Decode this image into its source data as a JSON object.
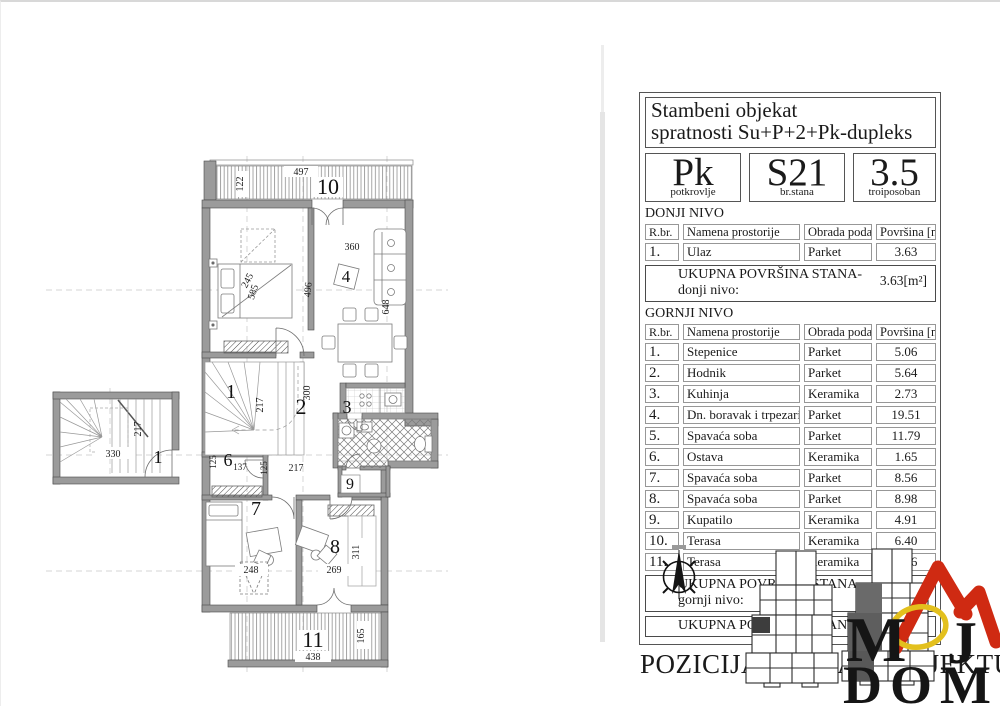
{
  "panel": {
    "title": {
      "line1": "Stambeni objekat",
      "line2": "spratnosti Su+P+2+Pk-dupleks"
    },
    "badges": [
      {
        "value": "Pk",
        "caption": "potkrovlje"
      },
      {
        "value": "S21",
        "caption": "br.stana"
      },
      {
        "value": "3.5",
        "caption": "troiposoban"
      }
    ],
    "donji": {
      "section": "DONJI NIVO",
      "col_num": "R.br.",
      "col_name": "Namena prostorije",
      "col_floor": "Obrada poda",
      "col_area": "Površina [m²]",
      "rows": [
        {
          "num": "1.",
          "name": "Ulaz",
          "floor": "Parket",
          "area": "3.63"
        }
      ],
      "total_label": "UKUPNA POVRŠINA STANA-donji nivo:",
      "total_value": "3.63[m²]"
    },
    "gornji": {
      "section": "GORNJI NIVO",
      "col_num": "R.br.",
      "col_name": "Namena prostorije",
      "col_floor": "Obrada poda",
      "col_area": "Površina [m²]",
      "rows": [
        {
          "num": "1.",
          "name": "Stepenice",
          "floor": "Parket",
          "area": "5.06"
        },
        {
          "num": "2.",
          "name": "Hodnik",
          "floor": "Parket",
          "area": "5.64"
        },
        {
          "num": "3.",
          "name": "Kuhinja",
          "floor": "Keramika",
          "area": "2.73"
        },
        {
          "num": "4.",
          "name": "Dn. boravak i trpezarija",
          "floor": "Parket",
          "area": "19.51"
        },
        {
          "num": "5.",
          "name": "Spavaća soba",
          "floor": "Parket",
          "area": "11.79"
        },
        {
          "num": "6.",
          "name": "Ostava",
          "floor": "Keramika",
          "area": "1.65"
        },
        {
          "num": "7.",
          "name": "Spavaća soba",
          "floor": "Parket",
          "area": "8.56"
        },
        {
          "num": "8.",
          "name": "Spavaća soba",
          "floor": "Parket",
          "area": "8.98"
        },
        {
          "num": "9.",
          "name": "Kupatilo",
          "floor": "Keramika",
          "area": "4.91"
        },
        {
          "num": "10.",
          "name": "Terasa",
          "floor": "Keramika",
          "area": "6.40"
        },
        {
          "num": "11.",
          "name": "Terasa",
          "floor": "Keramika",
          "area": "8.16"
        }
      ],
      "total_label": "UKUPNA POVRŠINA STANA-gornji nivo:",
      "total_value": "83.39[m²]"
    },
    "grand_total_label": "UKUPNA POVRŠINA STANA:",
    "grand_total_value": "87.02[m²]",
    "position_heading": "POZICIJA STANA U OBJEKTU"
  },
  "plan": {
    "labels": [
      "497",
      "122",
      "10",
      "245",
      "585",
      "360",
      "4",
      "496",
      "648",
      "1",
      "217",
      "2",
      "300",
      "3",
      "6",
      "137",
      "125",
      "125",
      "217",
      "9",
      "7",
      "248",
      "8",
      "269",
      "311",
      "11",
      "438",
      "165",
      "330",
      "217",
      "1"
    ]
  },
  "logo": {
    "letter_m": "M",
    "letter_j": "J",
    "word_bottom": "DOM",
    "red": "#cf2a12",
    "yellow": "#e3c01d"
  }
}
